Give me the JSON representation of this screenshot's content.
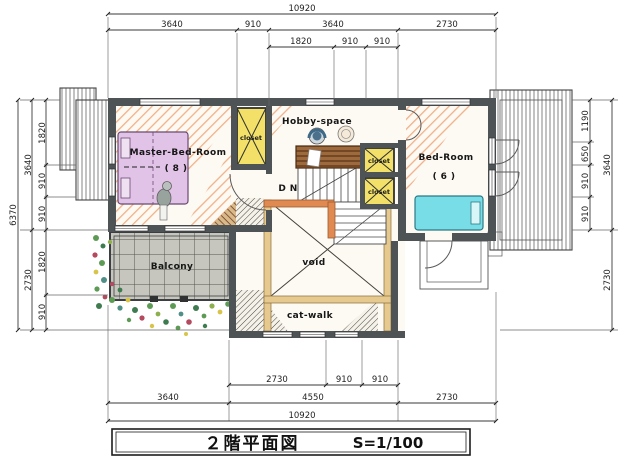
{
  "title_block": {
    "title": "２階平面図",
    "scale": "S=1/100"
  },
  "dimensions": {
    "top": {
      "total": "10920",
      "row2": [
        "3640",
        "910",
        "3640",
        "2730"
      ],
      "row3": [
        "1820",
        "910",
        "910"
      ]
    },
    "left": {
      "total": "6370",
      "outer": [
        "3640",
        "2730"
      ],
      "inner": [
        "1820",
        "910",
        "910",
        "1820",
        "910"
      ]
    },
    "right": {
      "outer": [
        "3640",
        "2730"
      ],
      "inner": [
        "1190",
        "650",
        "910",
        "910"
      ]
    },
    "bottom": {
      "row1": [
        "2730",
        "910",
        "910"
      ],
      "row2": [
        "3640",
        "4550",
        "2730"
      ],
      "total": "10920"
    }
  },
  "rooms": {
    "master_bedroom": {
      "label": "Master-Bed-Room",
      "size": "( 8 )"
    },
    "bedroom": {
      "label": "Bed-Room",
      "size": "( 6 )"
    },
    "hobby_space": {
      "label": "Hobby-space"
    },
    "balcony": {
      "label": "Balcony"
    },
    "void": {
      "label": "void"
    },
    "catwalk": {
      "label": "cat-walk"
    },
    "stairs": {
      "label": "D N"
    },
    "closet_master": "closet",
    "closet_upper": "closet",
    "closet_lower": "closet"
  },
  "colors": {
    "wall": "#4e5356",
    "closet_fill": "#f2e068",
    "master_bed": "#e2c3e8",
    "bedroom_bed": "#79dde8",
    "railing": "#e08a52",
    "void_frame": "#e6c98f",
    "hatch_orange": "#f2b088",
    "balcony_tile": "#c6c6be"
  }
}
